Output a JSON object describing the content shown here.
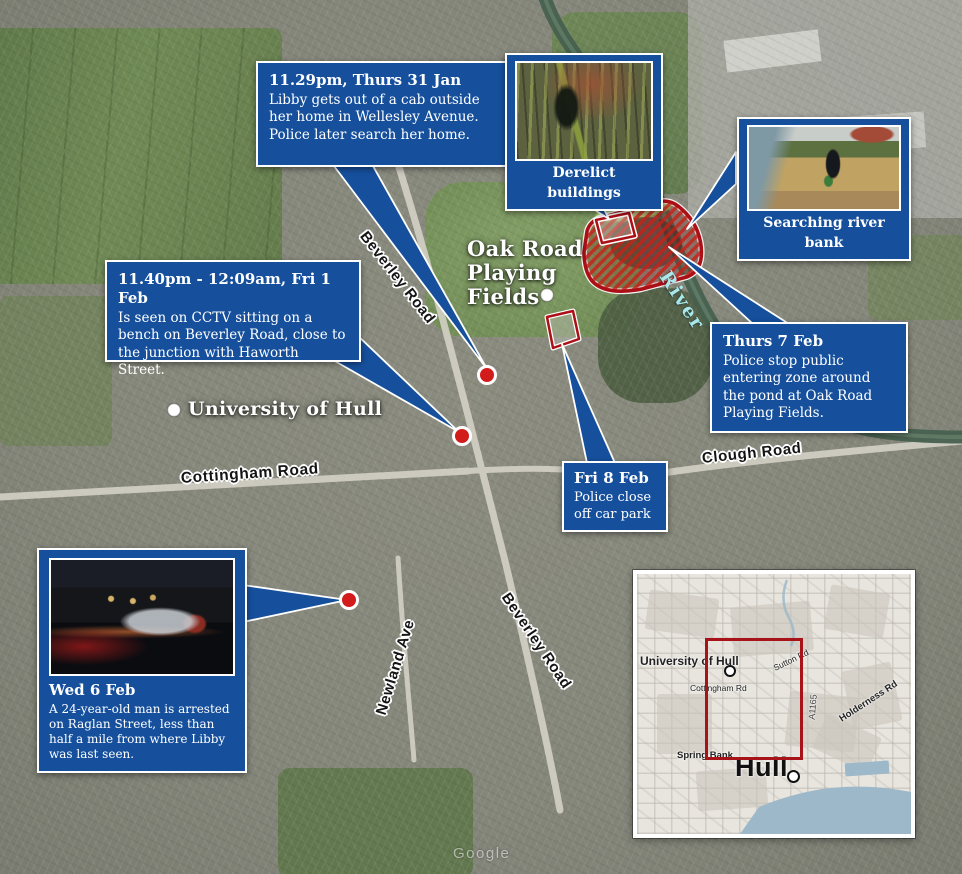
{
  "callouts": {
    "cab": {
      "title": "11.29pm, Thurs 31 Jan",
      "body": "Libby gets out of a cab outside her home in Wellesley Avenue. Police later search her home."
    },
    "cctv": {
      "title": "11.40pm - 12:09am, Fri 1 Feb",
      "body": "Is seen on CCTV sitting on a bench on Beverley Road, close to the junction with Haworth Street."
    },
    "derelict": {
      "label": "Derelict buildings"
    },
    "riverbank": {
      "label": "Searching river bank"
    },
    "pond": {
      "title": "Thurs 7 Feb",
      "body": "Police stop public entering zone around the pond at Oak Road Playing Fields."
    },
    "carpark": {
      "title": "Fri 8 Feb",
      "body": "Police close off car park"
    },
    "arrest": {
      "title": "Wed 6 Feb",
      "body": "A 24-year-old man is arrested on Raglan Street, less than half a mile from where Libby was last seen."
    }
  },
  "map_labels": {
    "oak_road_lines": [
      "Oak Road",
      "Playing",
      "Fields"
    ],
    "university": "University of Hull",
    "beverley_road": "Beverley Road",
    "cottingham_road": "Cottingham Road",
    "clough_road": "Clough Road",
    "newland_ave": "Newland Ave",
    "river": "River",
    "watermark": "Google"
  },
  "inset_labels": {
    "university": "University of Hull",
    "cottingham_rd": "Cottingham Rd",
    "sutton_rd": "Sutton Rd",
    "road_number": "A1165",
    "holderness_rd": "Holderness Rd",
    "spring_bank": "Spring Bank",
    "hull": "Hull"
  },
  "colors": {
    "callout_blue": "#16509d",
    "zone_red": "#ab1016",
    "marker_red": "#d21b1b",
    "river_label": "#a9e7ea",
    "inset_water": "#9cb8c9"
  }
}
